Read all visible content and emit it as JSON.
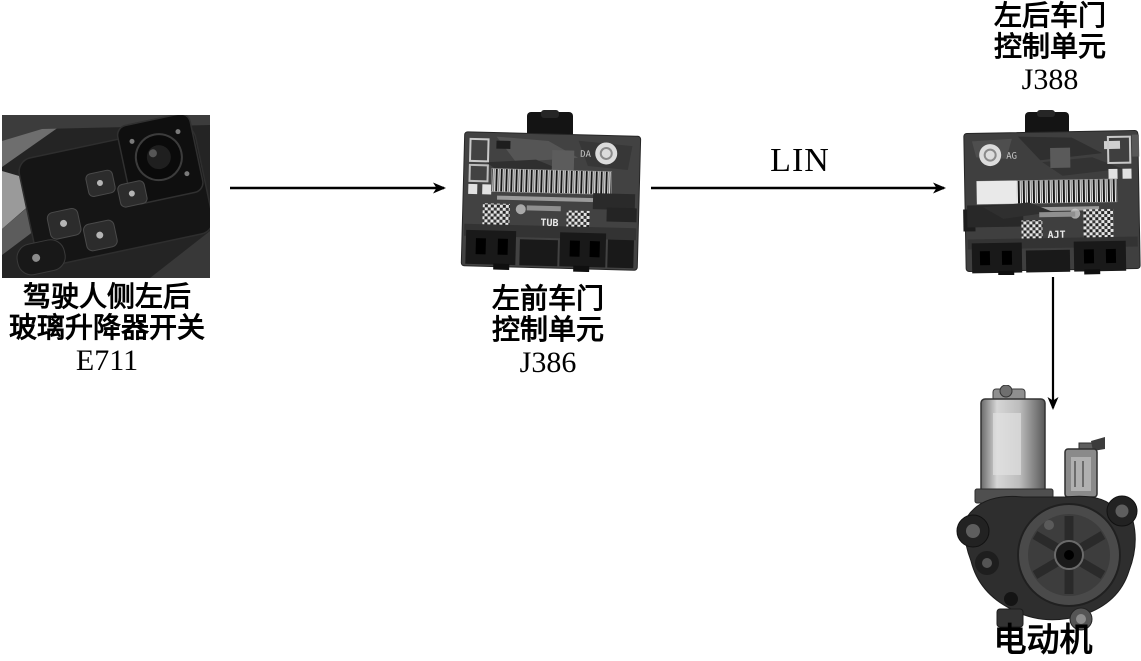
{
  "diagram": {
    "nodes": {
      "switch": {
        "photo": "driver-side-window-switch-photo",
        "lines": [
          "驾驶人侧左后",
          "玻璃升降器开关",
          "E711"
        ]
      },
      "front_left_door_module": {
        "photo": "front-left-door-control-unit-photo",
        "lines": [
          "左前车门",
          "控制单元",
          "J386"
        ],
        "markings": {
          "emblem": "DA",
          "print": "TUB"
        }
      },
      "rear_left_door_module": {
        "photo": "rear-left-door-control-unit-photo",
        "lines": [
          "左后车门",
          "控制单元",
          "J388"
        ],
        "markings": {
          "emblem": "AG",
          "print": "AJT"
        }
      },
      "motor": {
        "photo": "window-lifter-motor-photo",
        "label": "电动机"
      }
    },
    "edges": {
      "switch_to_j386": "",
      "j386_to_j388": "LIN",
      "j388_to_motor": ""
    },
    "colors": {
      "background": "#ffffff",
      "arrow": "#000000",
      "text": "#000000"
    }
  }
}
